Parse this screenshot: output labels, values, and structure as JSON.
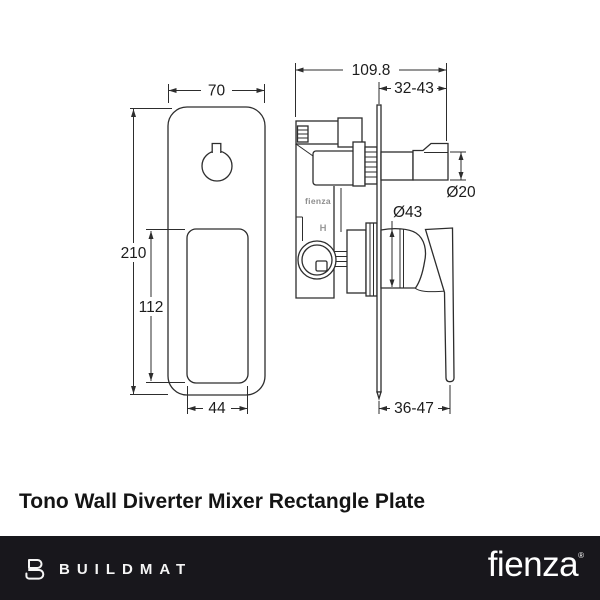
{
  "title": "Tono Wall Diverter Mixer Rectangle Plate",
  "drawing": {
    "front_view": {
      "width_label": "70",
      "height_label": "210",
      "cutout_height_label": "112",
      "cutout_width_label": "44"
    },
    "side_view": {
      "depth_label": "109.8",
      "spindle_range_label": "32-43",
      "spindle_dia_label": "Ø20",
      "escutcheon_dia_label": "Ø43",
      "handle_range_label": "36-47",
      "body_brand_label": "fienza",
      "hot_marker_label": "H"
    }
  },
  "footer": {
    "buildmat_label": "BUILDMAT",
    "fienza_label": "fienza",
    "reg_mark": "®"
  },
  "colors": {
    "line": "#2d2d2d",
    "footer_bg": "#18171c",
    "title_text": "#141414",
    "footer_text": "#ffffff"
  }
}
